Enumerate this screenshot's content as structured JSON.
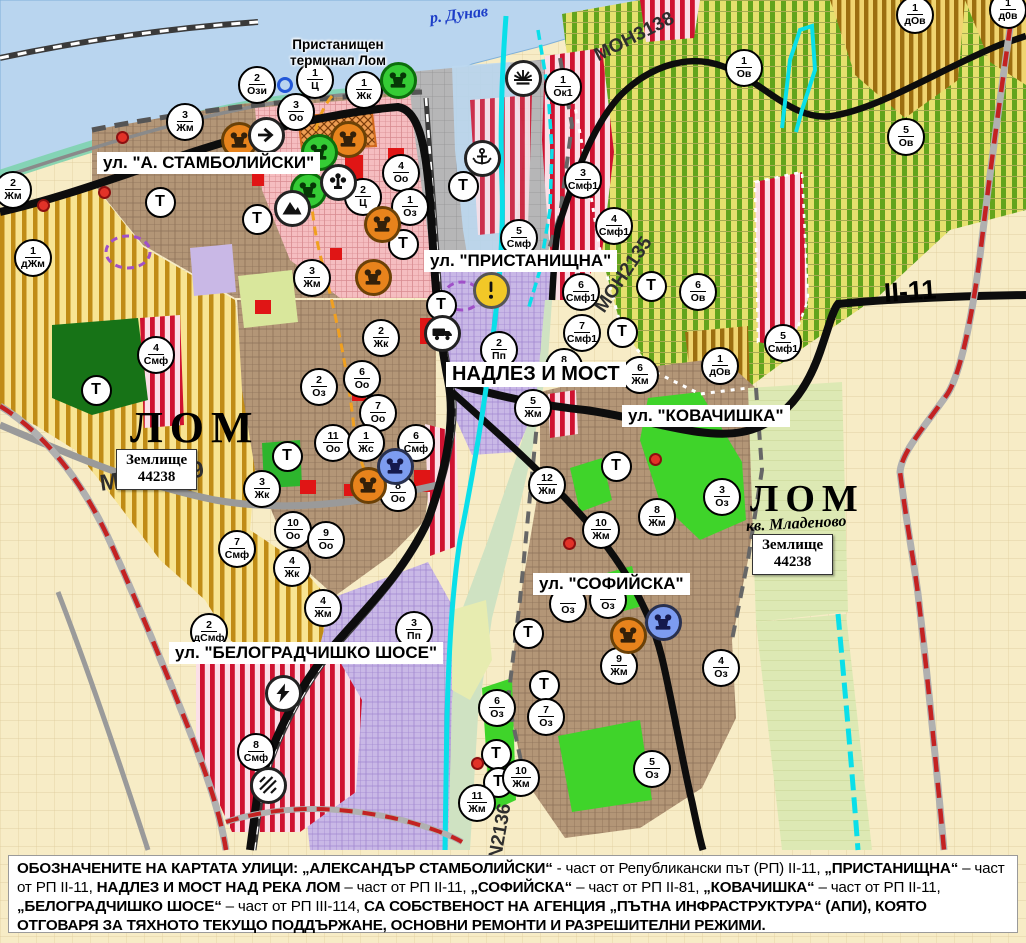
{
  "map_title": "Устройствен план - гр. Лом",
  "t_label": "Т",
  "palette": {
    "water": "#b9d5ef",
    "agri_yellow": "#f8e492",
    "agri_stripe": "#c08c16",
    "vineyard": "#e6e06e",
    "vineyard_stripe": "#63a41d",
    "urban_brown": "#b39677",
    "central_pink": "#f5bdc0",
    "industrial_lavender": "#c9b8e6",
    "smf_red": "#cf1230",
    "park_green": "#3fd42a",
    "forest_green": "#177317",
    "port_gray": "#b6b6b7",
    "canal_cyan": "#0adfe9",
    "boundary_red": "#c32222",
    "road_black": "#0d0d0d",
    "marker_orange": "#e8831c",
    "marker_green": "#35cc35",
    "marker_blue": "#7d9cf0",
    "warn_yellow": "#f2c827"
  },
  "labels": [
    {
      "id": "river-danube",
      "cls": "river",
      "text": "р. Дунав",
      "x": 430,
      "y": 10,
      "fs": 16,
      "rot": -7
    },
    {
      "id": "port-terminal",
      "cls": "place",
      "text": "Пристанищен\nтерминал Лом",
      "x": 290,
      "y": 37,
      "fs": 13.5,
      "rot": 0
    },
    {
      "id": "street-stamboliyski",
      "cls": "street",
      "text": "ул. \"А. СТАМБОЛИЙСКИ\"",
      "x": 97,
      "y": 152,
      "fs": 17,
      "rot": 0
    },
    {
      "id": "street-pristanishtna",
      "cls": "street",
      "text": "ул. \"ПРИСТАНИЩНА\"",
      "x": 424,
      "y": 250,
      "fs": 17,
      "rot": 0
    },
    {
      "id": "street-nadlez-i-most",
      "cls": "street",
      "text": "НАДЛЕЗ И МОСТ",
      "x": 446,
      "y": 362,
      "fs": 20,
      "rot": 0
    },
    {
      "id": "street-kovachishka",
      "cls": "street",
      "text": "ул. \"КОВАЧИШКА\"",
      "x": 622,
      "y": 405,
      "fs": 17,
      "rot": 0
    },
    {
      "id": "street-sofiyska",
      "cls": "street",
      "text": "ул. \"СОФИЙСКА\"",
      "x": 533,
      "y": 573,
      "fs": 17,
      "rot": 0
    },
    {
      "id": "street-belogradchishko",
      "cls": "street",
      "text": "ул. \"БЕЛОГРАДЧИШКО ШОСЕ\"",
      "x": 169,
      "y": 642,
      "fs": 17,
      "rot": 0
    },
    {
      "id": "city-lom-1",
      "cls": "city",
      "text": "ЛОМ",
      "x": 130,
      "y": 406,
      "fs": 44,
      "rot": 0
    },
    {
      "id": "boxed-zemlishte-1",
      "cls": "boxed",
      "text": "Землище\n44238",
      "x": 116,
      "y": 449,
      "fs": 15,
      "rot": 0
    },
    {
      "id": "road-mon3139",
      "cls": "roadname",
      "text": "MOH3139",
      "x": 100,
      "y": 470,
      "fs": 23,
      "rot": -8
    },
    {
      "id": "road-mon3138",
      "cls": "roadname",
      "text": "MOH3138",
      "x": 596,
      "y": 46,
      "fs": 19,
      "rot": -27
    },
    {
      "id": "road-mon2135",
      "cls": "roadname",
      "text": "MOH2135",
      "x": 600,
      "y": 300,
      "fs": 19,
      "rot": -56
    },
    {
      "id": "road-n2136",
      "cls": "roadname",
      "text": "N2136",
      "x": 496,
      "y": 848,
      "fs": 19,
      "rot": -80
    },
    {
      "id": "road-ii-11",
      "cls": "roadref",
      "text": "II-11",
      "x": 884,
      "y": 278,
      "fs": 27,
      "rot": -4
    },
    {
      "id": "city-lom-2",
      "cls": "city",
      "text": "ЛОМ",
      "x": 750,
      "y": 480,
      "fs": 38,
      "rot": 0
    },
    {
      "id": "suburb-mladenovo",
      "cls": "suburb",
      "text": "кв. Младеново",
      "x": 746,
      "y": 518,
      "fs": 16,
      "rot": -3
    },
    {
      "id": "boxed-zemlishte-2",
      "cls": "boxed",
      "text": "Землище\n44238",
      "x": 752,
      "y": 534,
      "fs": 15,
      "rot": 0
    }
  ],
  "zone_markers": [
    {
      "x": 13,
      "y": 190,
      "n": "2",
      "a": "Жм"
    },
    {
      "x": 257,
      "y": 85,
      "n": "2",
      "a": "Ози"
    },
    {
      "x": 315,
      "y": 80,
      "n": "1",
      "a": "Ц"
    },
    {
      "x": 364,
      "y": 90,
      "n": "1",
      "a": "Жк"
    },
    {
      "x": 296,
      "y": 112,
      "n": "3",
      "a": "Оо"
    },
    {
      "x": 185,
      "y": 122,
      "n": "3",
      "a": "Жм"
    },
    {
      "x": 401,
      "y": 173,
      "n": "4",
      "a": "Оо"
    },
    {
      "x": 363,
      "y": 197,
      "n": "2",
      "a": "Ц"
    },
    {
      "x": 410,
      "y": 207,
      "n": "1",
      "a": "Оз"
    },
    {
      "x": 33,
      "y": 258,
      "n": "1",
      "a": "дЖм"
    },
    {
      "x": 312,
      "y": 278,
      "n": "3",
      "a": "Жм"
    },
    {
      "x": 156,
      "y": 355,
      "n": "4",
      "a": "Смф"
    },
    {
      "x": 381,
      "y": 338,
      "n": "2",
      "a": "Жк"
    },
    {
      "x": 362,
      "y": 379,
      "n": "6",
      "a": "Оо"
    },
    {
      "x": 319,
      "y": 387,
      "n": "2",
      "a": "Оз"
    },
    {
      "x": 378,
      "y": 413,
      "n": "7",
      "a": "Оо"
    },
    {
      "x": 333,
      "y": 443,
      "n": "11",
      "a": "Оо"
    },
    {
      "x": 366,
      "y": 443,
      "n": "1",
      "a": "Жс"
    },
    {
      "x": 416,
      "y": 443,
      "n": "6",
      "a": "Смф"
    },
    {
      "x": 398,
      "y": 493,
      "n": "8",
      "a": "Оо"
    },
    {
      "x": 262,
      "y": 489,
      "n": "3",
      "a": "Жк"
    },
    {
      "x": 293,
      "y": 530,
      "n": "10",
      "a": "Оо"
    },
    {
      "x": 326,
      "y": 540,
      "n": "9",
      "a": "Оо"
    },
    {
      "x": 292,
      "y": 568,
      "n": "4",
      "a": "Жк"
    },
    {
      "x": 237,
      "y": 549,
      "n": "7",
      "a": "Смф"
    },
    {
      "x": 323,
      "y": 608,
      "n": "4",
      "a": "Жм"
    },
    {
      "x": 209,
      "y": 632,
      "n": "2",
      "a": "дСмф"
    },
    {
      "x": 414,
      "y": 630,
      "n": "3",
      "a": "Пп"
    },
    {
      "x": 256,
      "y": 752,
      "n": "8",
      "a": "Смф"
    },
    {
      "x": 519,
      "y": 238,
      "n": "5",
      "a": "Смф"
    },
    {
      "x": 583,
      "y": 180,
      "n": "3",
      "a": "Смф1"
    },
    {
      "x": 614,
      "y": 226,
      "n": "4",
      "a": "Смф1"
    },
    {
      "x": 581,
      "y": 292,
      "n": "6",
      "a": "Смф1"
    },
    {
      "x": 582,
      "y": 333,
      "n": "7",
      "a": "Смф1"
    },
    {
      "x": 499,
      "y": 350,
      "n": "2",
      "a": "Пп"
    },
    {
      "x": 564,
      "y": 367,
      "n": "8",
      "a": "Жм"
    },
    {
      "x": 533,
      "y": 408,
      "n": "5",
      "a": "Жм"
    },
    {
      "x": 640,
      "y": 375,
      "n": "6",
      "a": "Жм"
    },
    {
      "x": 698,
      "y": 292,
      "n": "6",
      "a": "Ов"
    },
    {
      "x": 783,
      "y": 343,
      "n": "5",
      "a": "Смф1"
    },
    {
      "x": 720,
      "y": 366,
      "n": "1",
      "a": "дОв"
    },
    {
      "x": 563,
      "y": 87,
      "n": "1",
      "a": "Ок1"
    },
    {
      "x": 744,
      "y": 68,
      "n": "1",
      "a": "Ов"
    },
    {
      "x": 906,
      "y": 137,
      "n": "5",
      "a": "Ов"
    },
    {
      "x": 915,
      "y": 15,
      "n": "1",
      "a": "дОв"
    },
    {
      "x": 1008,
      "y": 10,
      "n": "1",
      "a": "д0в"
    },
    {
      "x": 547,
      "y": 485,
      "n": "12",
      "a": "Жм"
    },
    {
      "x": 601,
      "y": 530,
      "n": "10",
      "a": "Жм"
    },
    {
      "x": 657,
      "y": 517,
      "n": "8",
      "a": "Жм"
    },
    {
      "x": 722,
      "y": 497,
      "n": "3",
      "a": "Оз"
    },
    {
      "x": 652,
      "y": 769,
      "n": "5",
      "a": "Оз"
    },
    {
      "x": 497,
      "y": 708,
      "n": "6",
      "a": "Оз"
    },
    {
      "x": 546,
      "y": 717,
      "n": "7",
      "a": "Оз"
    },
    {
      "x": 521,
      "y": 778,
      "n": "10",
      "a": "Жм"
    },
    {
      "x": 477,
      "y": 803,
      "n": "11",
      "a": "Жм"
    },
    {
      "x": 619,
      "y": 666,
      "n": "9",
      "a": "Жм"
    },
    {
      "x": 721,
      "y": 668,
      "n": "4",
      "a": "Оз"
    },
    {
      "x": 568,
      "y": 604,
      "n": "",
      "a": "Оз"
    },
    {
      "x": 608,
      "y": 600,
      "n": "",
      "a": "Оз"
    }
  ],
  "t_markers": [
    {
      "x": 160,
      "y": 202
    },
    {
      "x": 257,
      "y": 219
    },
    {
      "x": 403,
      "y": 244
    },
    {
      "x": 463,
      "y": 186
    },
    {
      "x": 441,
      "y": 305
    },
    {
      "x": 651,
      "y": 286
    },
    {
      "x": 622,
      "y": 332
    },
    {
      "x": 96,
      "y": 390
    },
    {
      "x": 287,
      "y": 456
    },
    {
      "x": 616,
      "y": 466
    },
    {
      "x": 528,
      "y": 633
    },
    {
      "x": 544,
      "y": 685
    },
    {
      "x": 496,
      "y": 754
    },
    {
      "x": 498,
      "y": 782
    }
  ],
  "icon_markers": [
    {
      "t": "monument",
      "c": "orange",
      "x": 239,
      "y": 140
    },
    {
      "t": "monument",
      "c": "orange",
      "x": 348,
      "y": 139
    },
    {
      "t": "monument",
      "c": "orange",
      "x": 382,
      "y": 224
    },
    {
      "t": "monument",
      "c": "orange",
      "x": 373,
      "y": 277
    },
    {
      "t": "monument",
      "c": "orange",
      "x": 368,
      "y": 485
    },
    {
      "t": "monument",
      "c": "orange",
      "x": 628,
      "y": 635
    },
    {
      "t": "monument",
      "c": "green",
      "x": 398,
      "y": 80
    },
    {
      "t": "monument",
      "c": "green",
      "x": 319,
      "y": 152
    },
    {
      "t": "monument",
      "c": "green",
      "x": 308,
      "y": 190
    },
    {
      "t": "monument",
      "c": "blue",
      "x": 395,
      "y": 466
    },
    {
      "t": "monument",
      "c": "blue",
      "x": 663,
      "y": 622
    },
    {
      "t": "arrow",
      "c": "white",
      "x": 266,
      "y": 135
    },
    {
      "t": "fountain",
      "c": "white",
      "x": 338,
      "y": 182
    },
    {
      "t": "mountain",
      "c": "white",
      "x": 292,
      "y": 208
    },
    {
      "t": "anchor",
      "c": "white",
      "x": 482,
      "y": 158
    },
    {
      "t": "sun",
      "c": "white",
      "x": 523,
      "y": 78
    },
    {
      "t": "truck",
      "c": "white",
      "x": 442,
      "y": 333
    },
    {
      "t": "lightning",
      "c": "white",
      "x": 283,
      "y": 693
    },
    {
      "t": "railcross",
      "c": "white",
      "x": 268,
      "y": 785
    },
    {
      "t": "warn",
      "c": "yellow",
      "x": 491,
      "y": 290
    }
  ],
  "point_features": [
    {
      "t": "blue-ring",
      "x": 285,
      "y": 85
    },
    {
      "t": "red-dot",
      "x": 122,
      "y": 137
    },
    {
      "t": "red-dot",
      "x": 104,
      "y": 192
    },
    {
      "t": "red-dot",
      "x": 43,
      "y": 205
    },
    {
      "t": "red-dot",
      "x": 655,
      "y": 459
    },
    {
      "t": "red-dot",
      "x": 569,
      "y": 543
    },
    {
      "t": "red-dot",
      "x": 477,
      "y": 763
    }
  ],
  "caption": {
    "segments": [
      {
        "b": true,
        "t": "ОБОЗНАЧЕНИТЕ НА КАРТАТА УЛИЦИ: „АЛЕКСАНДЪР СТАМБОЛИЙСКИ“"
      },
      {
        "b": false,
        "t": " - част от Републикански път (РП) II-11, "
      },
      {
        "b": true,
        "t": "„ПРИСТАНИЩНА“"
      },
      {
        "b": false,
        "t": " – част от РП II-11, "
      },
      {
        "b": true,
        "t": "НАДЛЕЗ И МОСТ НАД РЕКА ЛОМ"
      },
      {
        "b": false,
        "t": " – част от РП II-11, "
      },
      {
        "b": true,
        "t": "„СОФИЙСКА“"
      },
      {
        "b": false,
        "t": " – част от РП II-81, "
      },
      {
        "b": true,
        "t": "„КОВАЧИШКА“"
      },
      {
        "b": false,
        "t": " – част от РП II-11, "
      },
      {
        "b": true,
        "t": "„БЕЛОГРАДЧИШКО ШОСЕ“"
      },
      {
        "b": false,
        "t": " – част от РП III-114, "
      },
      {
        "b": true,
        "t": "СА СОБСТВЕНОСТ НА АГЕНЦИЯ „ПЪТНА ИНФРАСТРУКТУРА“ (АПИ), КОЯТО ОТГОВАРЯ ЗА ТЯХНОТО ТЕКУЩО ПОДДЪРЖАНЕ, ОСНОВНИ РЕМОНТИ И РАЗРЕШИТЕЛНИ РЕЖИМИ."
      }
    ]
  }
}
